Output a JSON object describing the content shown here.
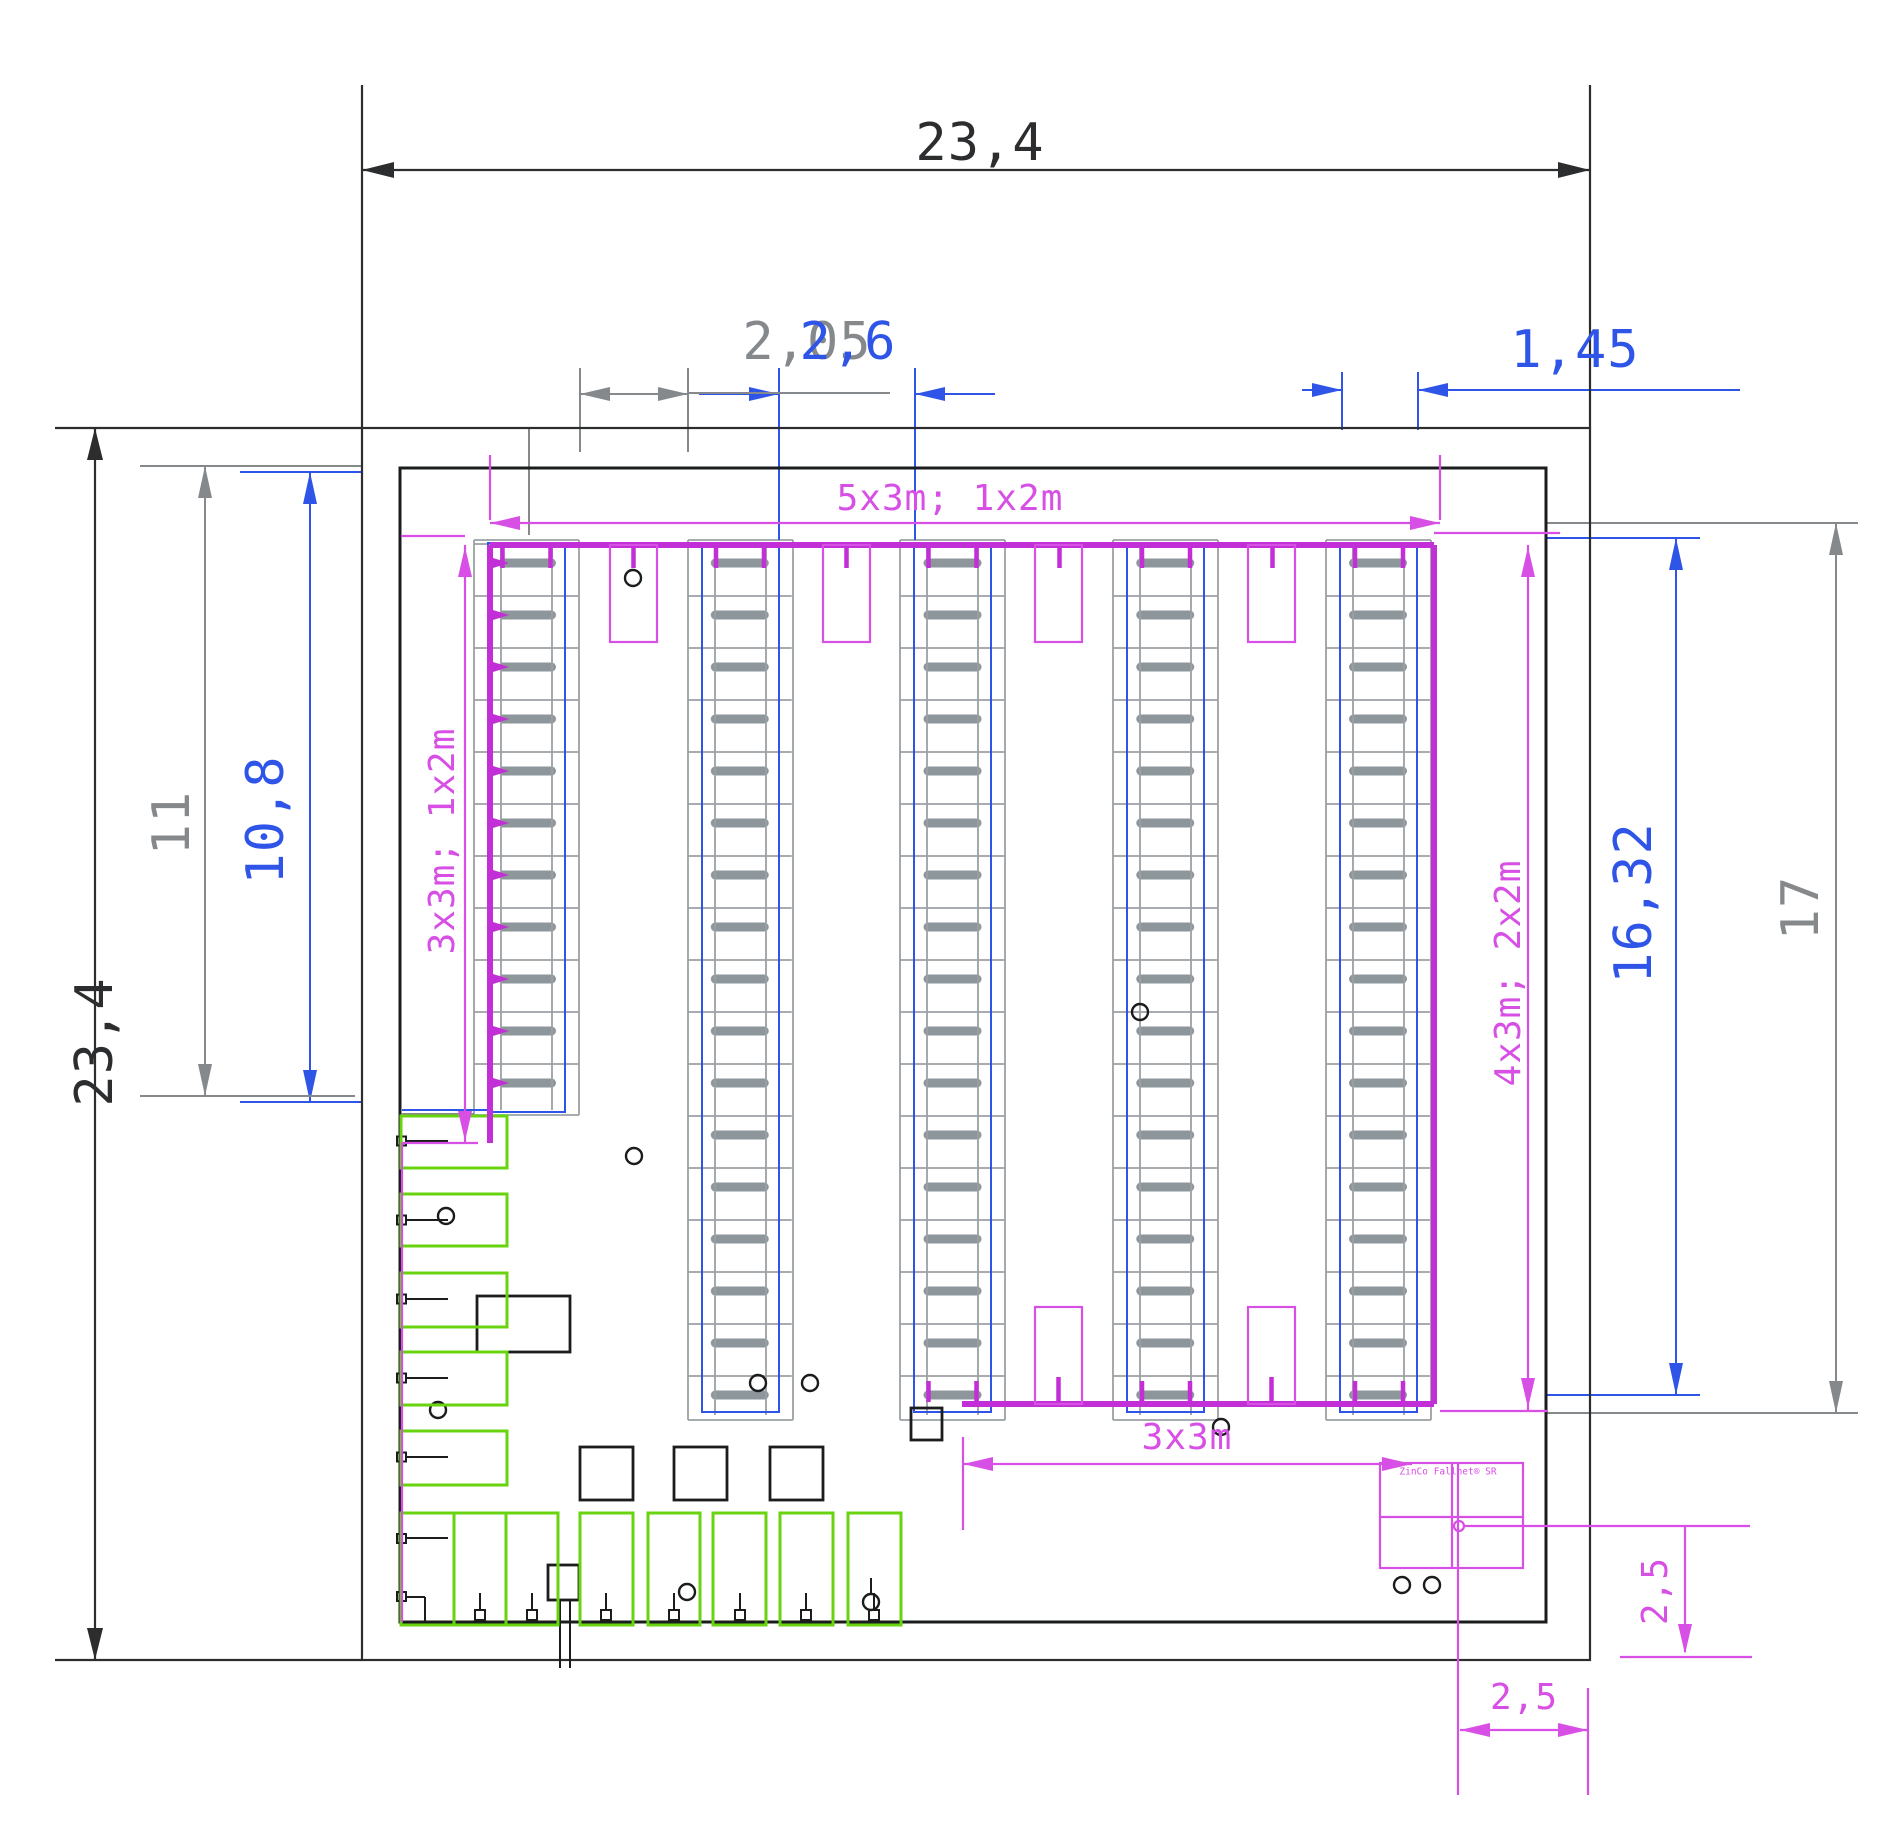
{
  "drawing": {
    "type": "warehouse floor plan (CAD)",
    "dimensions": {
      "width_total": "23,4",
      "height_total": "23,4",
      "left_bay_gray": "11",
      "left_bay_blue": "10,8",
      "top_small_gray": "2,05",
      "top_small_blue": "2,6",
      "top_right": "1,45",
      "right_blue": "16,32",
      "right_gray": "17",
      "offset_vertical": "2,5",
      "offset_horizontal": "2,5",
      "span_bottom": "3x3m"
    },
    "module_labels": {
      "racks_top": "5x3m; 1x2m",
      "racks_left": "3x3m; 1x2m",
      "racks_right": "4x3m; 2x2m"
    },
    "block_label": "ZinCo Fallnet® SR",
    "colors": {
      "dim_dark": "#2b2d2f",
      "dim_gray": "#85898c",
      "dim_blue": "#2f55e8",
      "magenta": "#d84fe6",
      "magenta_bold": "#c32fd6",
      "green": "#67d40f",
      "rack_gray": "#9ba0a4",
      "bar_gray": "#8d969a",
      "wall_dark": "#1b1c1d"
    }
  }
}
